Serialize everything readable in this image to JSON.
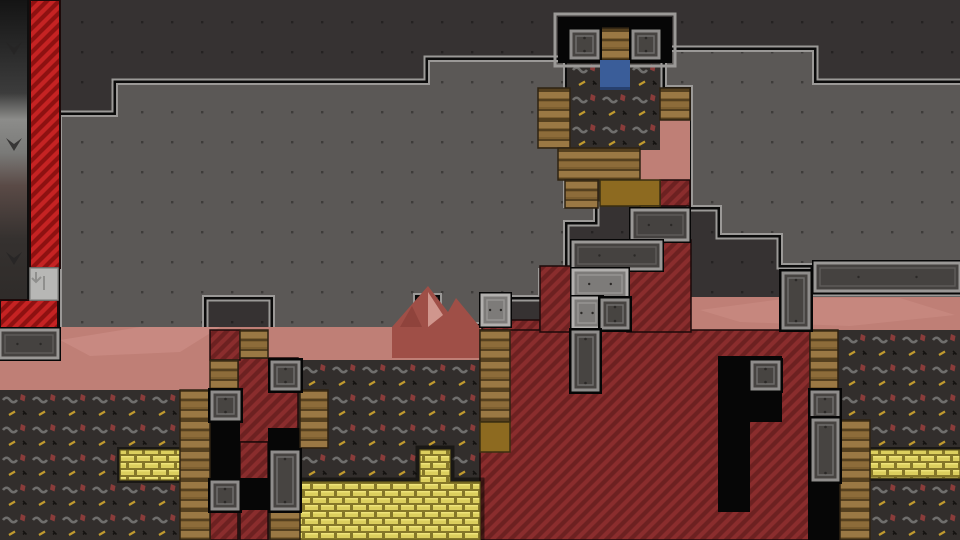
{
  "scene": {
    "w": 960,
    "h": 540,
    "tile": 30
  },
  "palette": {
    "bg": "#363232",
    "dot": "rgba(0,0,0,0.32)",
    "room": "#5b5856",
    "outline_light": "#9b9997",
    "outline_dark": "#0b0b0b",
    "pink": "#bf7f76",
    "pink_hi": "#cf928a",
    "mountain": "#9f4f47",
    "mountain_dark": "#8f433c",
    "mountain_hi": "#d8a29a",
    "chevron_bg": "#322e2c",
    "chev_gray": "#6f6e6c",
    "chev_red": "#8a3c3a",
    "chev_yellow": "#c09a2e",
    "chev_black": "#141210",
    "red_bright": "#c52323",
    "red_bright_stripe": "#8e1111",
    "red_dark": "#6d2121",
    "red_dark_stripe": "#8a2d2d",
    "red_edge": "#1d0a0a",
    "wood_a": "#9a7844",
    "wood_b": "#7d5f30",
    "wood_line": "#55401f",
    "wood_edge": "#2e2212",
    "wood_mustard": "#8d6a20",
    "gold_bg": "#857729",
    "gold_brick": "#dccf5e",
    "gold_hi": "#efe47a",
    "gold_edge": "#6b5f1e",
    "stone_fill": "#454240",
    "stone_frame": "#9a9896",
    "stone_inner": "#5f5d5a",
    "stone_light_fill": "#7d7b79",
    "stone_light_frame": "#b2b0ae",
    "cracked": "#b7b7b5",
    "cracked_mark": "#8f8f8d",
    "door_fill": "#474441",
    "door_frame": "#8f8d8b",
    "door_inner": "#6e6c6a",
    "door_dot": "#2b2927",
    "black": "#060606",
    "blue": "#3a5d99",
    "blue_edge": "#27406e",
    "edge_stops": [
      "#141414",
      "#3c3c3c",
      "#8c8c8a",
      "#7a7a78",
      "#5a4a46",
      "#35312f",
      "#2c2927"
    ]
  },
  "regions": {
    "left_room_path": "M62,117 H118 V85 H430 V62 H563 V208 H593 V220 H563 V268 H538 V295 H482 V322 H442 V293 H413 V327 H275 V295 H202 V327 H62 Z",
    "right_room_path": "M667,52 H812 V85 H960 V290 H815 V263 H783 V233 H722 V205 H693 V85 H667 Z",
    "chevron_left_path": "M0,390 H210 V360 H480 V540 H0 Z",
    "chevron_rects": [
      [
        567,
        58,
        93,
        92
      ],
      [
        838,
        330,
        122,
        210
      ],
      [
        640,
        88,
        20,
        32
      ]
    ],
    "pink_rects": [
      [
        0,
        327,
        540,
        63
      ],
      [
        690,
        297,
        270,
        36
      ],
      [
        640,
        118,
        50,
        62
      ]
    ],
    "pink_blob": [
      274,
      396,
      36,
      30
    ],
    "pink_highlights": [
      {
        "points": "60,340 140,327 220,327 180,352 90,356",
        "opacity": 0.55
      },
      {
        "points": "700,310 790,298 900,298 955,315 850,326 740,322",
        "opacity": 0.45
      }
    ],
    "mountain": "392,327 428,286 448,312 456,298 480,327 480,358 392,358",
    "mountain_dark": "400,327 412,306 422,327",
    "mountain_hi": "428,292 443,315 428,327",
    "edge_strip": [
      0,
      0,
      30,
      332
    ],
    "edge_chevrons": [
      [
        6,
        42
      ],
      [
        6,
        138
      ],
      [
        6,
        252
      ]
    ],
    "tower_top_outline": [
      555,
      14,
      120,
      52
    ],
    "tower_top_black": [
      558,
      17,
      114,
      46
    ]
  },
  "blocks": {
    "red_bright": [
      [
        30,
        0,
        30,
        268
      ],
      [
        0,
        300,
        58,
        28
      ]
    ],
    "red_dark": [
      [
        482,
        320,
        58,
        12
      ],
      [
        480,
        330,
        330,
        210
      ],
      [
        540,
        266,
        34,
        66
      ],
      [
        627,
        240,
        64,
        92
      ],
      [
        660,
        180,
        30,
        26
      ],
      [
        238,
        358,
        60,
        84
      ],
      [
        210,
        330,
        30,
        30
      ],
      [
        240,
        442,
        28,
        38
      ],
      [
        240,
        508,
        28,
        32
      ],
      [
        210,
        508,
        28,
        32
      ]
    ],
    "black_holes": [
      [
        718,
        356,
        64,
        66
      ],
      [
        718,
        420,
        32,
        92
      ],
      [
        210,
        418,
        30,
        92
      ],
      [
        240,
        478,
        28,
        32
      ],
      [
        268,
        428,
        32,
        26
      ],
      [
        808,
        390,
        34,
        152
      ]
    ],
    "gold_path": "M300,482 H420 V450 H450 V482 H480 V540 H300 Z",
    "gold_rects": [
      [
        120,
        450,
        60,
        30
      ],
      [
        870,
        450,
        90,
        28
      ]
    ],
    "wood": [
      [
        538,
        88,
        32,
        60
      ],
      [
        660,
        88,
        30,
        32
      ],
      [
        558,
        148,
        82,
        32
      ],
      [
        565,
        180,
        33,
        28
      ],
      [
        598,
        28,
        32,
        32
      ],
      [
        480,
        330,
        30,
        92
      ],
      [
        210,
        360,
        28,
        30
      ],
      [
        180,
        390,
        30,
        150
      ],
      [
        240,
        330,
        28,
        28
      ],
      [
        270,
        508,
        30,
        32
      ],
      [
        300,
        390,
        28,
        58
      ],
      [
        810,
        330,
        28,
        62
      ],
      [
        840,
        420,
        30,
        120
      ]
    ],
    "wood_mustard": [
      [
        480,
        422,
        30,
        30
      ],
      [
        600,
        180,
        60,
        26
      ],
      [
        640,
        206,
        20,
        34
      ]
    ],
    "stone_dark": [
      [
        0,
        330,
        58,
        28
      ],
      [
        632,
        210,
        56,
        30
      ],
      [
        573,
        242,
        88,
        27
      ],
      [
        815,
        263,
        145,
        28
      ]
    ],
    "stone_light": [
      [
        573,
        270,
        54,
        28
      ],
      [
        573,
        298,
        28,
        30
      ],
      [
        482,
        295,
        27,
        30
      ]
    ],
    "cracked_block": [
      30,
      268,
      28,
      32
    ],
    "doors_square": [
      [
        571,
        31,
        27,
        27
      ],
      [
        633,
        31,
        26,
        27
      ],
      [
        212,
        392,
        27,
        27
      ],
      [
        272,
        362,
        27,
        27
      ],
      [
        212,
        482,
        26,
        27
      ],
      [
        812,
        392,
        26,
        27
      ],
      [
        752,
        362,
        27,
        27
      ],
      [
        602,
        300,
        26,
        28
      ]
    ],
    "doors_tall": [
      [
        573,
        332,
        25,
        58
      ],
      [
        272,
        452,
        26,
        57
      ],
      [
        783,
        273,
        26,
        55
      ],
      [
        813,
        420,
        25,
        60
      ]
    ],
    "blue_block": [
      600,
      60,
      30,
      30
    ]
  }
}
